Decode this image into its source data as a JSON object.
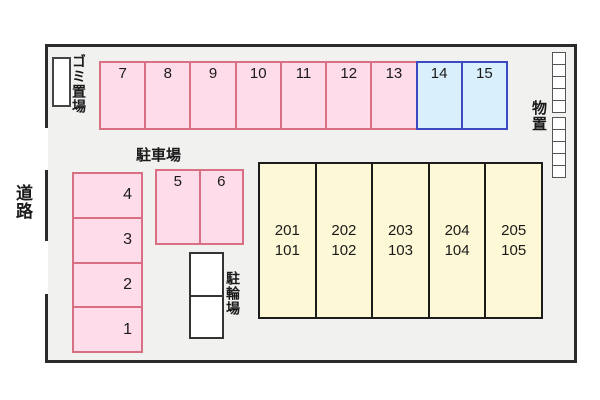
{
  "labels": {
    "road": "道路",
    "garbage": "ゴミ置場",
    "parking": "駐車場",
    "bicycle": "駐輪場",
    "storage": "物置"
  },
  "parking": {
    "top_row": [
      "7",
      "8",
      "9",
      "10",
      "11",
      "12",
      "13",
      "14",
      "15"
    ],
    "left_column": [
      "4",
      "3",
      "2",
      "1"
    ],
    "center_pair": [
      "5",
      "6"
    ]
  },
  "building": {
    "units": [
      {
        "upper": "201",
        "lower": "101"
      },
      {
        "upper": "202",
        "lower": "102"
      },
      {
        "upper": "203",
        "lower": "103"
      },
      {
        "upper": "204",
        "lower": "104"
      },
      {
        "upper": "205",
        "lower": "105"
      }
    ]
  },
  "colors": {
    "pink_fill": "#ffdce9",
    "pink_border": "#d96f83",
    "blue_fill": "#d9effb",
    "blue_border": "#3d49c1",
    "building_fill": "#fdf8d6",
    "site_background": "#f1f1ef",
    "outline": "#2b2b2b"
  }
}
